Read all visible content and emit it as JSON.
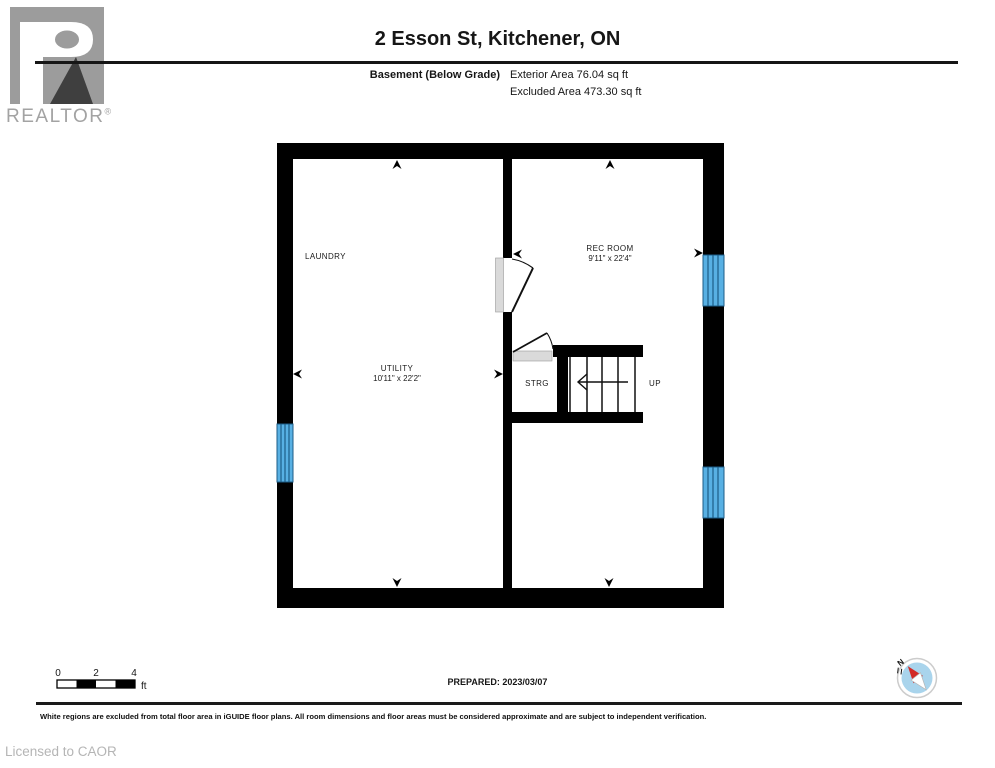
{
  "header": {
    "wordmark": "REALTOR",
    "registered": "®",
    "title": "2 Esson St, Kitchener, ON",
    "floor_label": "Basement (Below Grade)",
    "exterior_area": "Exterior Area 76.04 sq ft",
    "excluded_area": "Excluded Area 473.30 sq ft"
  },
  "floorplan": {
    "rooms": {
      "laundry": {
        "name": "LAUNDRY"
      },
      "utility": {
        "name": "UTILITY",
        "dims": "10'11\" x 22'2\""
      },
      "rec_room": {
        "name": "REC ROOM",
        "dims": "9'11\" x 22'4\""
      },
      "storage": {
        "name": "STRG"
      }
    },
    "stairs": {
      "direction_label": "UP"
    },
    "colors": {
      "wall": "#000000",
      "window_fill": "#58b0e3",
      "window_line": "#1c5d87",
      "door_panel": "#dadada"
    }
  },
  "scale_bar": {
    "ticks": [
      "0",
      "2",
      "4"
    ],
    "unit": "ft"
  },
  "prepared_label": "PREPARED: 2023/03/07",
  "compass": {
    "north_label": "N"
  },
  "footer": {
    "disclaimer": "White regions are excluded from total floor area in iGUIDE floor plans. All room dimensions and floor areas must be considered approximate and are subject to independent verification.",
    "license": "Licensed to CAOR"
  }
}
